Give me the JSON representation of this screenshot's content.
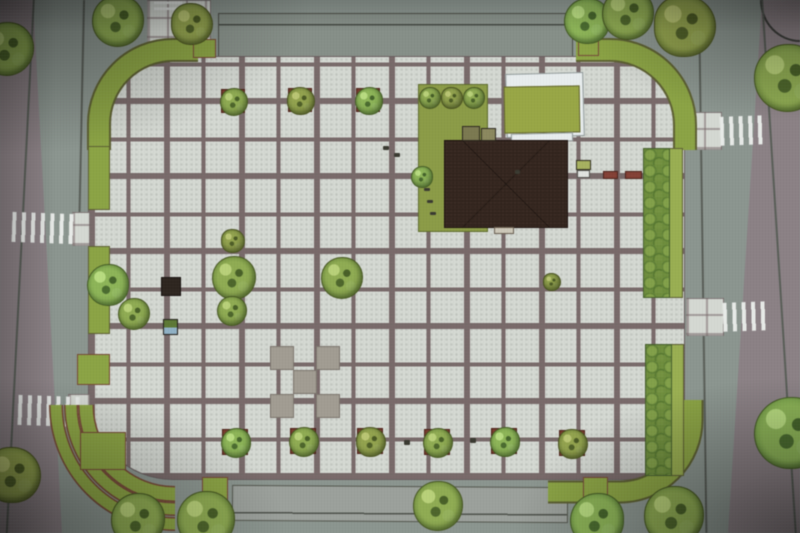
{
  "meta": {
    "type": "architectural-site-plan-photo",
    "title": "Town square landscape plan, top view (photo of rendered plan)",
    "canvas": {
      "width": 800,
      "height": 533
    }
  },
  "palette": {
    "road": "#8b958f",
    "pavement": "#8d8287",
    "tile": "#d6dad4",
    "grout": "#7b6b6b",
    "green_band": "#8ba63e",
    "green_light": "#9ab14c",
    "lawn": "#8c9d41",
    "lawn2": "#99a93f",
    "building": "#34251e",
    "canopy": "#e9eef0",
    "planter": "#7c3b2c",
    "bench_red": "#8a4034",
    "band_outline": "#5e6130",
    "terrace_outline": "#7a4a35"
  },
  "layers": {
    "rects_under": [
      {
        "n": "pavement-left",
        "x": 0,
        "y": 0,
        "w": 70,
        "h": 533,
        "c": "pavement",
        "clip": "polygon(0 0, 33px 0, 62px 100%, 0 100%)"
      },
      {
        "n": "pavement-right",
        "x": 720,
        "y": 0,
        "w": 80,
        "h": 533,
        "c": "pavement",
        "clip": "polygon(42px 0, 100% 0, 100% 100%, 8px 100%)"
      },
      {
        "n": "pavement-corner-bottom-left",
        "x": 0,
        "y": 436,
        "w": 62,
        "h": 97,
        "c": "pavement",
        "clip": "polygon(0 0, 35% 0, 100% 100%, 0 100%)"
      },
      {
        "n": "curb-curve-top-right",
        "x": 760,
        "y": 0,
        "w": 40,
        "h": 42,
        "cls": "curve-tr"
      },
      {
        "n": "road-lane-top",
        "x": 218,
        "y": 13,
        "w": 355,
        "h": 44,
        "cls": "roadstrip"
      },
      {
        "n": "road-lane-bottom",
        "x": 232,
        "y": 486,
        "w": 336,
        "h": 36,
        "cls": "roadstrip2",
        "rot": 0.4
      },
      {
        "n": "road-edge-left-outer",
        "x": 33,
        "y": -4,
        "w": 2,
        "h": 545,
        "cls": "rline",
        "rot": 2.9
      },
      {
        "n": "road-edge-left-inner",
        "x": 83,
        "y": 0,
        "w": 2,
        "h": 212,
        "cls": "rline",
        "rot": 1.2
      },
      {
        "n": "curb-curve-bottom-left",
        "x": 50,
        "y": 405,
        "w": 120,
        "h": 125,
        "cls": "curve-bl"
      },
      {
        "n": "road-edge-right-inner",
        "x": 698,
        "y": 0,
        "w": 2,
        "h": 533,
        "cls": "rline",
        "rot": -0.8
      },
      {
        "n": "road-edge-right-outer",
        "x": 761,
        "y": -3,
        "w": 2,
        "h": 540,
        "cls": "rline",
        "rot": -3.6
      },
      {
        "n": "plaza-paving",
        "x": 88,
        "y": 56,
        "w": 597,
        "h": 424,
        "cls": "plaza",
        "br": "62px 70px 60px 85px"
      },
      {
        "n": "approach-path-top",
        "x": 147,
        "y": 0,
        "w": 64,
        "h": 58,
        "cls": "tilepatch"
      },
      {
        "n": "crossing-landing-right-1",
        "x": 684,
        "y": 112,
        "w": 38,
        "h": 38,
        "cls": "tilepatch"
      },
      {
        "n": "crossing-landing-right-2",
        "x": 686,
        "y": 298,
        "w": 38,
        "h": 38,
        "cls": "tilepatch"
      },
      {
        "n": "crossing-landing-left-1",
        "x": 72,
        "y": 212,
        "w": 18,
        "h": 34,
        "cls": "tilepatch"
      },
      {
        "n": "crossing-landing-left-2",
        "x": 68,
        "y": 394,
        "w": 22,
        "h": 38,
        "cls": "tilepatch"
      },
      {
        "n": "accent-tile",
        "x": 270,
        "y": 346,
        "w": 24,
        "h": 24,
        "cls": "darktile"
      },
      {
        "n": "accent-tile",
        "x": 316,
        "y": 346,
        "w": 24,
        "h": 24,
        "cls": "darktile"
      },
      {
        "n": "accent-tile",
        "x": 293,
        "y": 370,
        "w": 24,
        "h": 24,
        "cls": "darktile"
      },
      {
        "n": "accent-tile",
        "x": 270,
        "y": 394,
        "w": 24,
        "h": 24,
        "cls": "darktile"
      },
      {
        "n": "accent-tile",
        "x": 316,
        "y": 394,
        "w": 24,
        "h": 24,
        "cls": "darktile"
      }
    ],
    "crosswalks": [
      {
        "n": "crosswalk-top",
        "x": 154,
        "y": 0,
        "w": 28,
        "h": 10,
        "dir": "h",
        "rot": 0
      },
      {
        "n": "crosswalk-left-1",
        "x": 12,
        "y": 213,
        "w": 62,
        "h": 30,
        "dir": "v",
        "rot": 2
      },
      {
        "n": "crosswalk-left-2",
        "x": 18,
        "y": 396,
        "w": 64,
        "h": 30,
        "dir": "v",
        "rot": 2
      },
      {
        "n": "crosswalk-right-1",
        "x": 720,
        "y": 116,
        "w": 47,
        "h": 29,
        "dir": "v",
        "rot": -2
      },
      {
        "n": "crosswalk-right-2",
        "x": 723,
        "y": 302,
        "w": 47,
        "h": 29,
        "dir": "v",
        "rot": -2
      }
    ],
    "green_arcs": [
      {
        "n": "green-band-corner-top-left",
        "d": "M 99 150 L 99 124 A 74 74 0 0 1 173 50 L 198 50",
        "w": 20,
        "o": 24,
        "t": 0
      },
      {
        "n": "green-band-corner-top-right",
        "d": "M 576 50 L 610 50 A 75 75 0 0 1 685 125 L 685 150",
        "w": 20,
        "o": 24,
        "t": 0
      },
      {
        "n": "green-band-corner-bottom-right",
        "d": "M 692 400 L 692 420 A 72 72 0 0 1 620 492 L 548 492",
        "w": 19,
        "o": 23,
        "t": 0
      },
      {
        "n": "terrace-step-1",
        "d": "M 86 405 A 89 89 0 0 0 175 494",
        "w": 13,
        "o": 16,
        "t": 1
      },
      {
        "n": "terrace-step-2",
        "d": "M 71 405 A 104 104 0 0 0 175 509",
        "w": 11,
        "o": 14,
        "t": 1
      },
      {
        "n": "terrace-step-3",
        "d": "M 56 405 A 119 119 0 0 0 175 524",
        "w": 11,
        "o": 14,
        "t": 1
      }
    ],
    "rects_over": [
      {
        "n": "green-strip-left-1",
        "x": 88,
        "y": 146,
        "w": 22,
        "h": 64,
        "c": "green_band",
        "b": "1px solid #5e6130"
      },
      {
        "n": "green-strip-left-2",
        "x": 88,
        "y": 246,
        "w": 22,
        "h": 88,
        "c": "green_band",
        "b": "1px solid #5e6130"
      },
      {
        "n": "green-strip-right-1",
        "x": 669,
        "y": 148,
        "w": 14,
        "h": 150,
        "c": "green_light",
        "b": "1px solid #5e6130"
      },
      {
        "n": "hedge-right-1",
        "x": 643,
        "y": 148,
        "w": 27,
        "h": 150,
        "cls": "hedge"
      },
      {
        "n": "green-strip-right-2",
        "x": 671,
        "y": 344,
        "w": 13,
        "h": 132,
        "c": "green_light",
        "b": "1px solid #5e6130"
      },
      {
        "n": "hedge-right-2",
        "x": 645,
        "y": 344,
        "w": 27,
        "h": 132,
        "cls": "hedge"
      },
      {
        "n": "terrace-lawn-block",
        "x": 80,
        "y": 432,
        "w": 46,
        "h": 38,
        "c": "green_band",
        "b": "1px solid #7a4a35"
      },
      {
        "n": "planter-green-left",
        "x": 77,
        "y": 354,
        "w": 33,
        "h": 31,
        "c": "green_band",
        "b": "1px solid #7a4a35"
      },
      {
        "n": "planter-green-top-left",
        "x": 193,
        "y": 39,
        "w": 23,
        "h": 19,
        "c": "green_band",
        "b": "1px solid #7a4a35"
      },
      {
        "n": "planter-green-top-right",
        "x": 578,
        "y": 40,
        "w": 21,
        "h": 16,
        "c": "green_band",
        "b": "1px solid #7a4a35"
      },
      {
        "n": "planter-green-bottom-left",
        "x": 202,
        "y": 477,
        "w": 26,
        "h": 23,
        "c": "green_band",
        "b": "1px solid #7a4a35"
      },
      {
        "n": "planter-green-bottom-right",
        "x": 583,
        "y": 477,
        "w": 25,
        "h": 22,
        "c": "green_band",
        "b": "1px solid #7a4a35"
      },
      {
        "n": "lawn-west-of-building",
        "x": 418,
        "y": 84,
        "w": 70,
        "h": 148,
        "c": "lawn",
        "b": "1px solid #5f6e2a"
      },
      {
        "n": "pergola-canopy",
        "x": 506,
        "y": 73,
        "w": 78,
        "h": 64,
        "c": "canopy",
        "b": "1px solid #8f9a99",
        "rot": -1.5
      },
      {
        "n": "pergola-lawn-roof",
        "x": 504,
        "y": 86,
        "w": 76,
        "h": 47,
        "c": "lawn2",
        "b": "1px solid #66682e",
        "rot": -1
      },
      {
        "n": "pergola-canopy-strip",
        "x": 511,
        "y": 133,
        "w": 62,
        "h": 9,
        "c": "canopy",
        "b": "1px solid #8f9a99",
        "rot": -1.5
      },
      {
        "n": "building-footprint",
        "x": 444,
        "y": 140,
        "w": 124,
        "h": 88,
        "cls": "building"
      },
      {
        "n": "building-vestibule-1",
        "x": 462,
        "y": 126,
        "w": 18,
        "h": 15,
        "bg": "#7d7a4e",
        "b": "1.5px solid #2f2a20"
      },
      {
        "n": "building-vestibule-2",
        "x": 481,
        "y": 128,
        "w": 15,
        "h": 13,
        "bg": "#8d8a5c",
        "b": "1.5px solid #2f2a20"
      },
      {
        "n": "building-entrance-step",
        "x": 494,
        "y": 227,
        "w": 20,
        "h": 7,
        "bg": "#cfc9b8",
        "b": "1px solid #6b5f50"
      },
      {
        "n": "kiosk-east-roof",
        "x": 576,
        "y": 160,
        "w": 15,
        "h": 10,
        "bg": "#a8b45a",
        "b": "1px solid #33301d"
      },
      {
        "n": "kiosk-east-base",
        "x": 577,
        "y": 170,
        "w": 13,
        "h": 8,
        "bg": "#e2e5e1",
        "b": "1px solid #555550"
      },
      {
        "n": "bench-east-1",
        "x": 603,
        "y": 171,
        "w": 15,
        "h": 8,
        "c": "bench_red",
        "b": "1px solid #4e2118"
      },
      {
        "n": "bench-east-2",
        "x": 625,
        "y": 171,
        "w": 17,
        "h": 8,
        "c": "bench_red",
        "b": "1px solid #4e2118"
      },
      {
        "n": "kiosk-west",
        "x": 161,
        "y": 277,
        "w": 20,
        "h": 19,
        "bg": "#2f2620",
        "b": "1px solid #191310"
      },
      {
        "n": "recycling-bin",
        "x": 163,
        "y": 319,
        "w": 15,
        "h": 16,
        "cls": "bin"
      }
    ],
    "marks": [
      {
        "x": 383,
        "y": 146,
        "w": 6,
        "h": 4
      },
      {
        "x": 394,
        "y": 153,
        "w": 6,
        "h": 4
      },
      {
        "x": 424,
        "y": 188,
        "w": 6,
        "h": 3
      },
      {
        "x": 427,
        "y": 200,
        "w": 6,
        "h": 3
      },
      {
        "x": 430,
        "y": 212,
        "w": 6,
        "h": 3
      },
      {
        "x": 404,
        "y": 440,
        "w": 6,
        "h": 5
      },
      {
        "x": 470,
        "y": 438,
        "w": 6,
        "h": 5
      },
      {
        "x": 515,
        "y": 170,
        "w": 5,
        "h": 4
      }
    ],
    "trees": [
      {
        "x": 6,
        "y": 48,
        "r": 26
      },
      {
        "x": 117,
        "y": 20,
        "r": 25
      },
      {
        "x": 191,
        "y": 23,
        "r": 20
      },
      {
        "x": 586,
        "y": 20,
        "r": 22
      },
      {
        "x": 627,
        "y": 13,
        "r": 25
      },
      {
        "x": 684,
        "y": 25,
        "r": 30
      },
      {
        "x": 787,
        "y": 77,
        "r": 33
      },
      {
        "x": 789,
        "y": 432,
        "r": 35
      },
      {
        "x": 12,
        "y": 474,
        "r": 27
      },
      {
        "x": 137,
        "y": 519,
        "r": 26
      },
      {
        "x": 205,
        "y": 519,
        "r": 28
      },
      {
        "x": 596,
        "y": 519,
        "r": 26
      },
      {
        "x": 673,
        "y": 515,
        "r": 29
      },
      {
        "x": 233,
        "y": 101,
        "r": 13,
        "p": 1
      },
      {
        "x": 300,
        "y": 100,
        "r": 13,
        "p": 1
      },
      {
        "x": 368,
        "y": 100,
        "r": 13,
        "p": 1
      },
      {
        "x": 429,
        "y": 97,
        "r": 10
      },
      {
        "x": 451,
        "y": 97,
        "r": 10
      },
      {
        "x": 473,
        "y": 97,
        "r": 10
      },
      {
        "x": 421,
        "y": 176,
        "r": 10
      },
      {
        "x": 232,
        "y": 240,
        "r": 11
      },
      {
        "x": 233,
        "y": 277,
        "r": 21
      },
      {
        "x": 231,
        "y": 310,
        "r": 14
      },
      {
        "x": 107,
        "y": 284,
        "r": 20
      },
      {
        "x": 133,
        "y": 313,
        "r": 15
      },
      {
        "x": 341,
        "y": 277,
        "r": 20
      },
      {
        "x": 551,
        "y": 281,
        "r": 8
      },
      {
        "x": 235,
        "y": 442,
        "r": 14,
        "p": 1
      },
      {
        "x": 303,
        "y": 441,
        "r": 14,
        "p": 1
      },
      {
        "x": 370,
        "y": 441,
        "r": 14,
        "p": 1
      },
      {
        "x": 437,
        "y": 442,
        "r": 14,
        "p": 1
      },
      {
        "x": 504,
        "y": 441,
        "r": 14,
        "p": 1
      },
      {
        "x": 572,
        "y": 443,
        "r": 14,
        "p": 1
      },
      {
        "x": 437,
        "y": 505,
        "r": 24
      }
    ]
  }
}
